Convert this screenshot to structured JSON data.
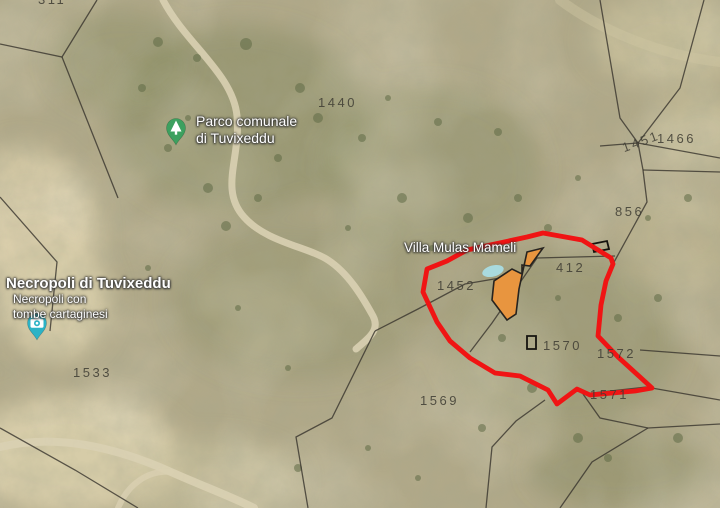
{
  "map": {
    "colors": {
      "red_boundary": "#f01414",
      "building_fill": "#e8953f",
      "building_stroke": "#26231f",
      "pool": "#a9dade",
      "parcel_line": "#34312a",
      "place_text": "#ffffff",
      "parcel_text": "#3e3c33",
      "park_pin": "#3da05f",
      "photo_pin": "#2cb3c6"
    },
    "place_labels": [
      {
        "name": "parco-comunale-label",
        "lines": [
          "Parco comunale",
          "di Tuvixeddu"
        ],
        "x": 196,
        "y": 113,
        "size": 14,
        "weight": 400
      },
      {
        "name": "necropoli-title-label",
        "lines": [
          "Necropoli di Tuvixeddu"
        ],
        "x": 6,
        "y": 275,
        "size": 15,
        "weight": 700
      },
      {
        "name": "necropoli-subtitle-label",
        "lines": [
          "Necropoli con",
          "tombe cartaginesi"
        ],
        "x": 13,
        "y": 292,
        "size": 12,
        "weight": 400
      },
      {
        "name": "villa-mulas-mameli-label",
        "lines": [
          "Villa Mulas Mameli"
        ],
        "x": 404,
        "y": 240,
        "size": 13.5,
        "weight": 400
      }
    ],
    "parcel_labels": [
      {
        "text": "311",
        "x": 38,
        "y": -8,
        "rot": 0
      },
      {
        "text": "1440",
        "x": 318,
        "y": 95,
        "rot": 0
      },
      {
        "text": "1451",
        "x": 620,
        "y": 141,
        "rot": -20
      },
      {
        "text": "1466",
        "x": 657,
        "y": 131,
        "rot": 0
      },
      {
        "text": "856",
        "x": 615,
        "y": 204,
        "rot": 0
      },
      {
        "text": "412",
        "x": 556,
        "y": 260,
        "rot": 0
      },
      {
        "text": "1452",
        "x": 437,
        "y": 278,
        "rot": 0
      },
      {
        "text": "1570",
        "x": 543,
        "y": 338,
        "rot": 0
      },
      {
        "text": "1572",
        "x": 597,
        "y": 346,
        "rot": 0
      },
      {
        "text": "1569",
        "x": 420,
        "y": 393,
        "rot": 0
      },
      {
        "text": "1571",
        "x": 590,
        "y": 387,
        "rot": 0
      },
      {
        "text": "1533",
        "x": 73,
        "y": 365,
        "rot": 0
      }
    ],
    "red_boundary_points": [
      [
        543,
        233
      ],
      [
        582,
        240
      ],
      [
        611,
        258
      ],
      [
        613,
        264
      ],
      [
        606,
        281
      ],
      [
        601,
        305
      ],
      [
        598,
        336
      ],
      [
        618,
        357
      ],
      [
        640,
        377
      ],
      [
        652,
        388
      ],
      [
        635,
        391
      ],
      [
        590,
        395
      ],
      [
        577,
        389
      ],
      [
        557,
        404
      ],
      [
        548,
        390
      ],
      [
        520,
        376
      ],
      [
        495,
        373
      ],
      [
        470,
        358
      ],
      [
        450,
        341
      ],
      [
        437,
        322
      ],
      [
        423,
        292
      ],
      [
        427,
        269
      ],
      [
        447,
        261
      ],
      [
        467,
        250
      ],
      [
        527,
        237
      ]
    ],
    "building_points": [
      [
        543,
        248
      ],
      [
        530,
        266
      ],
      [
        522,
        265
      ],
      [
        522,
        274
      ],
      [
        512,
        269
      ],
      [
        494,
        281
      ],
      [
        492,
        300
      ],
      [
        507,
        320
      ],
      [
        516,
        314
      ],
      [
        519,
        289
      ],
      [
        527,
        252
      ]
    ],
    "pool": {
      "cx": 493,
      "cy": 271,
      "rx": 11,
      "ry": 5.5,
      "rotation": -15
    },
    "parcel_lines": [
      [
        [
          97,
          0
        ],
        [
          62,
          57
        ],
        [
          0,
          44
        ]
      ],
      [
        [
          62,
          57
        ],
        [
          118,
          198
        ]
      ],
      [
        [
          600,
          0
        ],
        [
          620,
          118
        ],
        [
          638,
          143
        ],
        [
          643,
          170
        ],
        [
          647,
          202
        ],
        [
          613,
          264
        ]
      ],
      [
        [
          638,
          143
        ],
        [
          680,
          88
        ],
        [
          704,
          0
        ]
      ],
      [
        [
          600,
          146
        ],
        [
          638,
          143
        ],
        [
          720,
          158
        ]
      ],
      [
        [
          643,
          170
        ],
        [
          720,
          172
        ]
      ],
      [
        [
          615,
          256
        ],
        [
          537,
          258
        ],
        [
          492,
          323
        ],
        [
          470,
          352
        ]
      ],
      [
        [
          500,
          278
        ],
        [
          465,
          284
        ],
        [
          418,
          309
        ],
        [
          375,
          331
        ]
      ],
      [
        [
          375,
          331
        ],
        [
          332,
          418
        ],
        [
          296,
          437
        ],
        [
          308,
          508
        ]
      ],
      [
        [
          545,
          400
        ],
        [
          516,
          421
        ],
        [
          492,
          447
        ],
        [
          486,
          508
        ]
      ],
      [
        [
          583,
          394
        ],
        [
          646,
          387
        ],
        [
          720,
          400
        ]
      ],
      [
        [
          583,
          394
        ],
        [
          600,
          418
        ],
        [
          648,
          428
        ],
        [
          720,
          424
        ]
      ],
      [
        [
          640,
          350
        ],
        [
          720,
          356
        ]
      ],
      [
        [
          0,
          197
        ],
        [
          57,
          262
        ],
        [
          50,
          331
        ]
      ],
      [
        [
          0,
          428
        ],
        [
          75,
          470
        ],
        [
          138,
          508
        ]
      ],
      [
        [
          560,
          508
        ],
        [
          592,
          462
        ],
        [
          648,
          428
        ]
      ]
    ],
    "building_icons": [
      {
        "points": [
          [
            527,
            336
          ],
          [
            536,
            336
          ],
          [
            536,
            349
          ],
          [
            527,
            349
          ]
        ]
      },
      {
        "points": [
          [
            592,
            244
          ],
          [
            607,
            241
          ],
          [
            609,
            249
          ],
          [
            594,
            252
          ]
        ]
      }
    ],
    "pins": [
      {
        "name": "park-pin",
        "icon": "tree",
        "x": 176,
        "y": 145
      },
      {
        "name": "photo-pin",
        "icon": "camera",
        "x": 37,
        "y": 340
      }
    ]
  }
}
